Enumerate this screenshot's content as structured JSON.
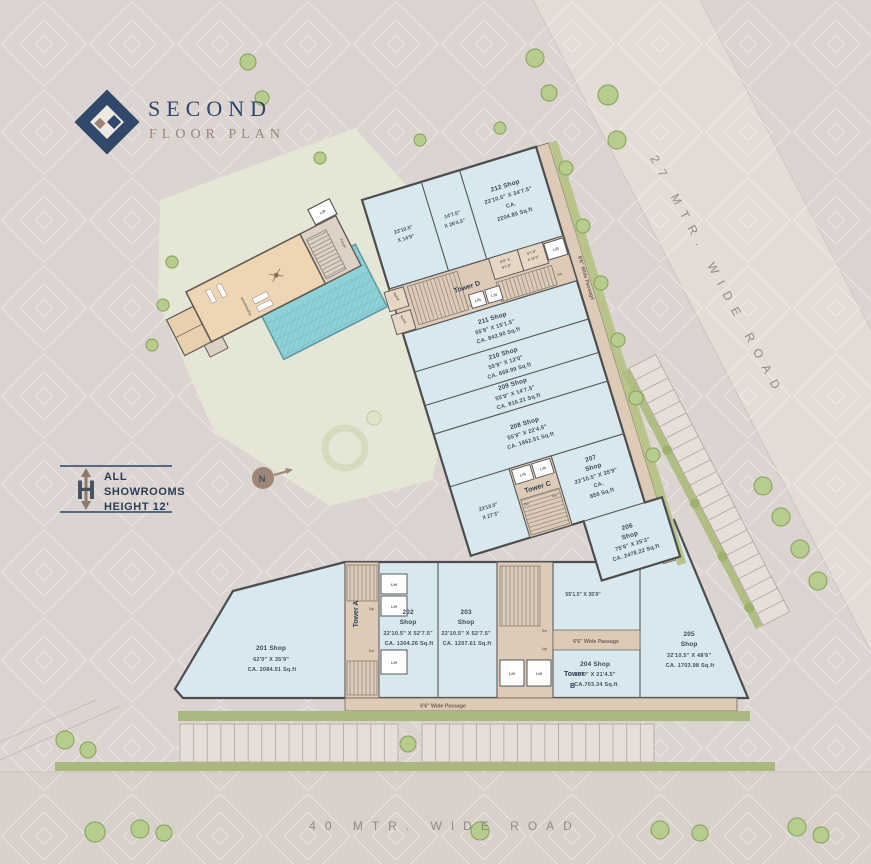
{
  "title": {
    "line1": "SECOND",
    "line2": "FLOOR PLAN"
  },
  "legend": {
    "symbol": "H",
    "line1": "ALL",
    "line2": "SHOWROOMS",
    "line3": "HEIGHT 12'"
  },
  "north_label": "N",
  "roads": {
    "right": "27 MTR. WIDE ROAD",
    "bottom": "40 MTR. WIDE ROAD"
  },
  "passage_label": "6'6\" Wide Passage",
  "labels": {
    "lift": "Lift",
    "up": "Up",
    "dn": "Dn",
    "toilet": "Toilet",
    "foyer": "Foyer",
    "gym": "Gymnasium"
  },
  "towers": {
    "a": "Tower A",
    "b1": "Tower",
    "b2": "B",
    "c": "Tower C",
    "d": "Tower D"
  },
  "shops": [
    {
      "id": "201",
      "lines": [
        "201 Shop",
        "62'0\" X 35'9\"",
        "CA. 2084.51 Sq.ft"
      ]
    },
    {
      "id": "202",
      "lines": [
        "202",
        "Shop",
        "22'10.5\" X 52'7.5\"",
        "CA. 1304.26 Sq.ft"
      ]
    },
    {
      "id": "203",
      "lines": [
        "203",
        "Shop",
        "22'10.5\" X 52'7.5\"",
        "CA. 1207.61 Sq.ft"
      ]
    },
    {
      "id": "204",
      "lines": [
        "204 Shop",
        "33'0\" X 21'4.5\"",
        "CA.703.34 Sq.ft"
      ]
    },
    {
      "id": "205",
      "lines": [
        "205",
        "Shop",
        "32'10.5\" X 48'6\"",
        "CA. 1703.98 Sq.ft"
      ]
    },
    {
      "id": "206",
      "lines": [
        "206",
        "Shop",
        "75'6\" X 25'3\"",
        "CA. 2478.22 Sq.ft"
      ]
    },
    {
      "id": "207",
      "lines": [
        "207",
        "Shop",
        "23'10.5\" X 35'9\"",
        "CA.",
        "856 Sq.ft"
      ]
    },
    {
      "id": "208",
      "lines": [
        "208 Shop",
        "55'9\" X 22'4.5\"",
        "CA. 1862.51 Sq.ft"
      ]
    },
    {
      "id": "209",
      "lines": [
        "209 Shop",
        "55'9\" X 14'7.5\"",
        "CA. 816.21 Sq.ft"
      ]
    },
    {
      "id": "210",
      "lines": [
        "210 Shop",
        "55'9\" X 12'0\"",
        "CA. 668.99 Sq.ft"
      ]
    },
    {
      "id": "211",
      "lines": [
        "211 Shop",
        "55'9\" X 15'1.5\"",
        "CA. 843.90 Sq.ft"
      ]
    },
    {
      "id": "212",
      "lines": [
        "212 Shop",
        "23'10.5\" X 34'7.5\"",
        "CA.",
        "2204.85 Sq.ft"
      ]
    }
  ],
  "rooms": {
    "r1a": [
      "23'10.5\"",
      "X 14'9\""
    ],
    "r1b": [
      "14'7.5\"",
      "X 26'4.5\""
    ],
    "d1": [
      "8'9\" X",
      "9'7.5\""
    ],
    "d2": [
      "8'7.5\"",
      "X 16'3\""
    ],
    "c1": [
      "23'10.5\"",
      "X 27'3\""
    ],
    "open": "55'1.5\" X 35'9\""
  },
  "colors": {
    "background": "#dbd4d0",
    "shop_fill": "#d7e8ee",
    "core_fill": "#ddcbb8",
    "wall": "#4d4d4d",
    "pool": "#8ed2d8",
    "green_strip": "#a9b87e",
    "tree": "#b7cd8e",
    "navy": "#2d4568",
    "taupe": "#9b8474",
    "road_text": "#8f8a86"
  }
}
